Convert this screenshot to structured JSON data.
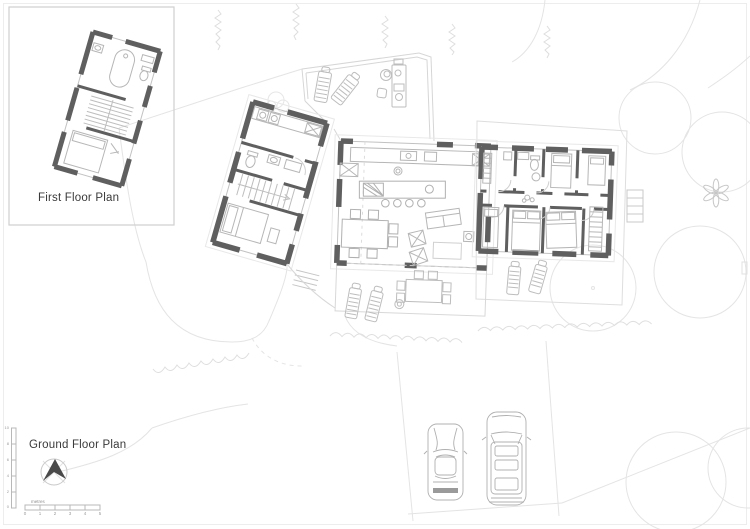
{
  "sheet": {
    "inset_label": "First Floor Plan",
    "main_label": "Ground Floor Plan"
  },
  "scale_bar": {
    "unit_label": "metres",
    "ticks": [
      "0",
      "1",
      "2",
      "3",
      "4",
      "5"
    ]
  },
  "vertical_scale": {
    "ticks": [
      "10",
      "8",
      "6",
      "4",
      "2",
      "0"
    ]
  },
  "colors": {
    "background": "#ffffff",
    "wall": "#5f5f5f",
    "detail_line": "#c4c4c4",
    "furniture_line": "#b6b6b6",
    "landscape_line": "#e2e2e2",
    "text": "#3a3a3a",
    "north_arrow_fill": "#4a4a4a"
  },
  "icons": {
    "north_arrow": "north-arrow-icon",
    "tree_canopy": "tree-canopy-icon",
    "conifer": "conifer-tree-icon",
    "flower_tree": "flower-tree-icon",
    "sports_car": "sports-car-icon",
    "suv_car": "suv-car-icon"
  }
}
